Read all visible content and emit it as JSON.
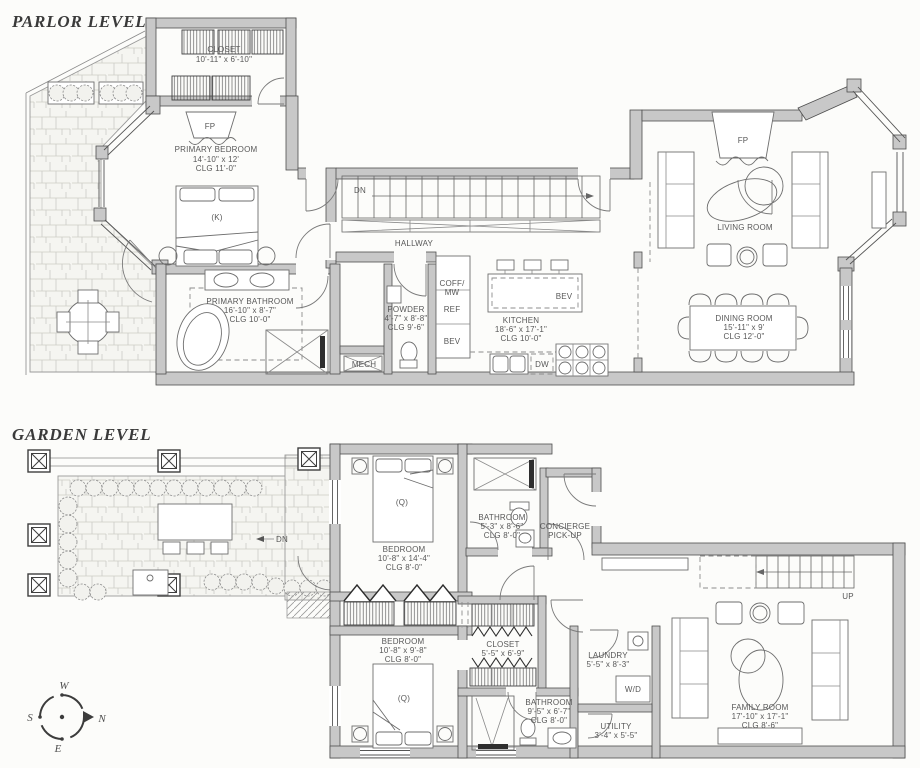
{
  "levels": {
    "parlor": {
      "title": "PARLOR LEVEL",
      "rooms": {
        "closet": {
          "name": "CLOSET",
          "dims": "10'-11\" x 6'-10\""
        },
        "primary_bedroom": {
          "name": "PRIMARY BEDROOM",
          "dims": "14'-10\" x 12'",
          "clg": "CLG 11'-0\"",
          "bed": "(K)",
          "fireplace": "FP"
        },
        "hallway": {
          "name": "HALLWAY",
          "stairs": "DN"
        },
        "primary_bathroom": {
          "name": "PRIMARY BATHROOM",
          "dims": "16'-10\" x 8'-7\"",
          "clg": "CLG 10'-0\""
        },
        "powder": {
          "name": "POWDER",
          "dims": "4'-7\" x 8'-8\"",
          "clg": "CLG 9'-6\""
        },
        "mech": {
          "name": "MECH"
        },
        "kitchen": {
          "name": "KITCHEN",
          "dims": "18'-6\" x 17'-1\"",
          "clg": "CLG 10'-0\"",
          "island": "BEV",
          "dishwasher": "DW",
          "appliances": [
            "COFF/",
            "MW",
            "REF",
            "BEV"
          ]
        },
        "living_room": {
          "name": "LIVING ROOM",
          "fireplace": "FP"
        },
        "dining_room": {
          "name": "DINING ROOM",
          "dims": "15'-11\" x 9'",
          "clg": "CLG 12'-0\""
        }
      }
    },
    "garden": {
      "title": "GARDEN LEVEL",
      "terrace_dn": "DN",
      "stairs_up": "UP",
      "rooms": {
        "bedroom1": {
          "name": "BEDROOM",
          "dims": "10'-8\" x 14'-4\"",
          "clg": "CLG 8'-0\"",
          "bed": "(Q)"
        },
        "bathroom1": {
          "name": "BATHROOM",
          "dims": "5'-3\" x 8'-6\"",
          "clg": "CLG 8'-0\""
        },
        "concierge": {
          "line1": "CONCIERGE",
          "line2": "PICK-UP"
        },
        "bedroom2": {
          "name": "BEDROOM",
          "dims": "10'-8\" x 9'-8\"",
          "clg": "CLG 8'-0\"",
          "bed": "(Q)"
        },
        "closet": {
          "name": "CLOSET",
          "dims": "5'-5\" x 6'-9\""
        },
        "laundry": {
          "name": "LAUNDRY",
          "dims": "5'-5\" x 8'-3\"",
          "appliance": "W/D"
        },
        "bathroom2": {
          "name": "BATHROOM",
          "dims": "9'-5\" x 6'-7\"",
          "clg": "CLG 8'-0\""
        },
        "utility": {
          "name": "UTILITY",
          "dims": "3'-4\" x 5'-5\""
        },
        "family_room": {
          "name": "FAMILY ROOM",
          "dims": "17'-10\" x 17'-1\"",
          "clg": "CLG 8'-6\""
        }
      }
    }
  },
  "compass": {
    "n": "N",
    "s": "S",
    "e": "E",
    "w": "W"
  }
}
